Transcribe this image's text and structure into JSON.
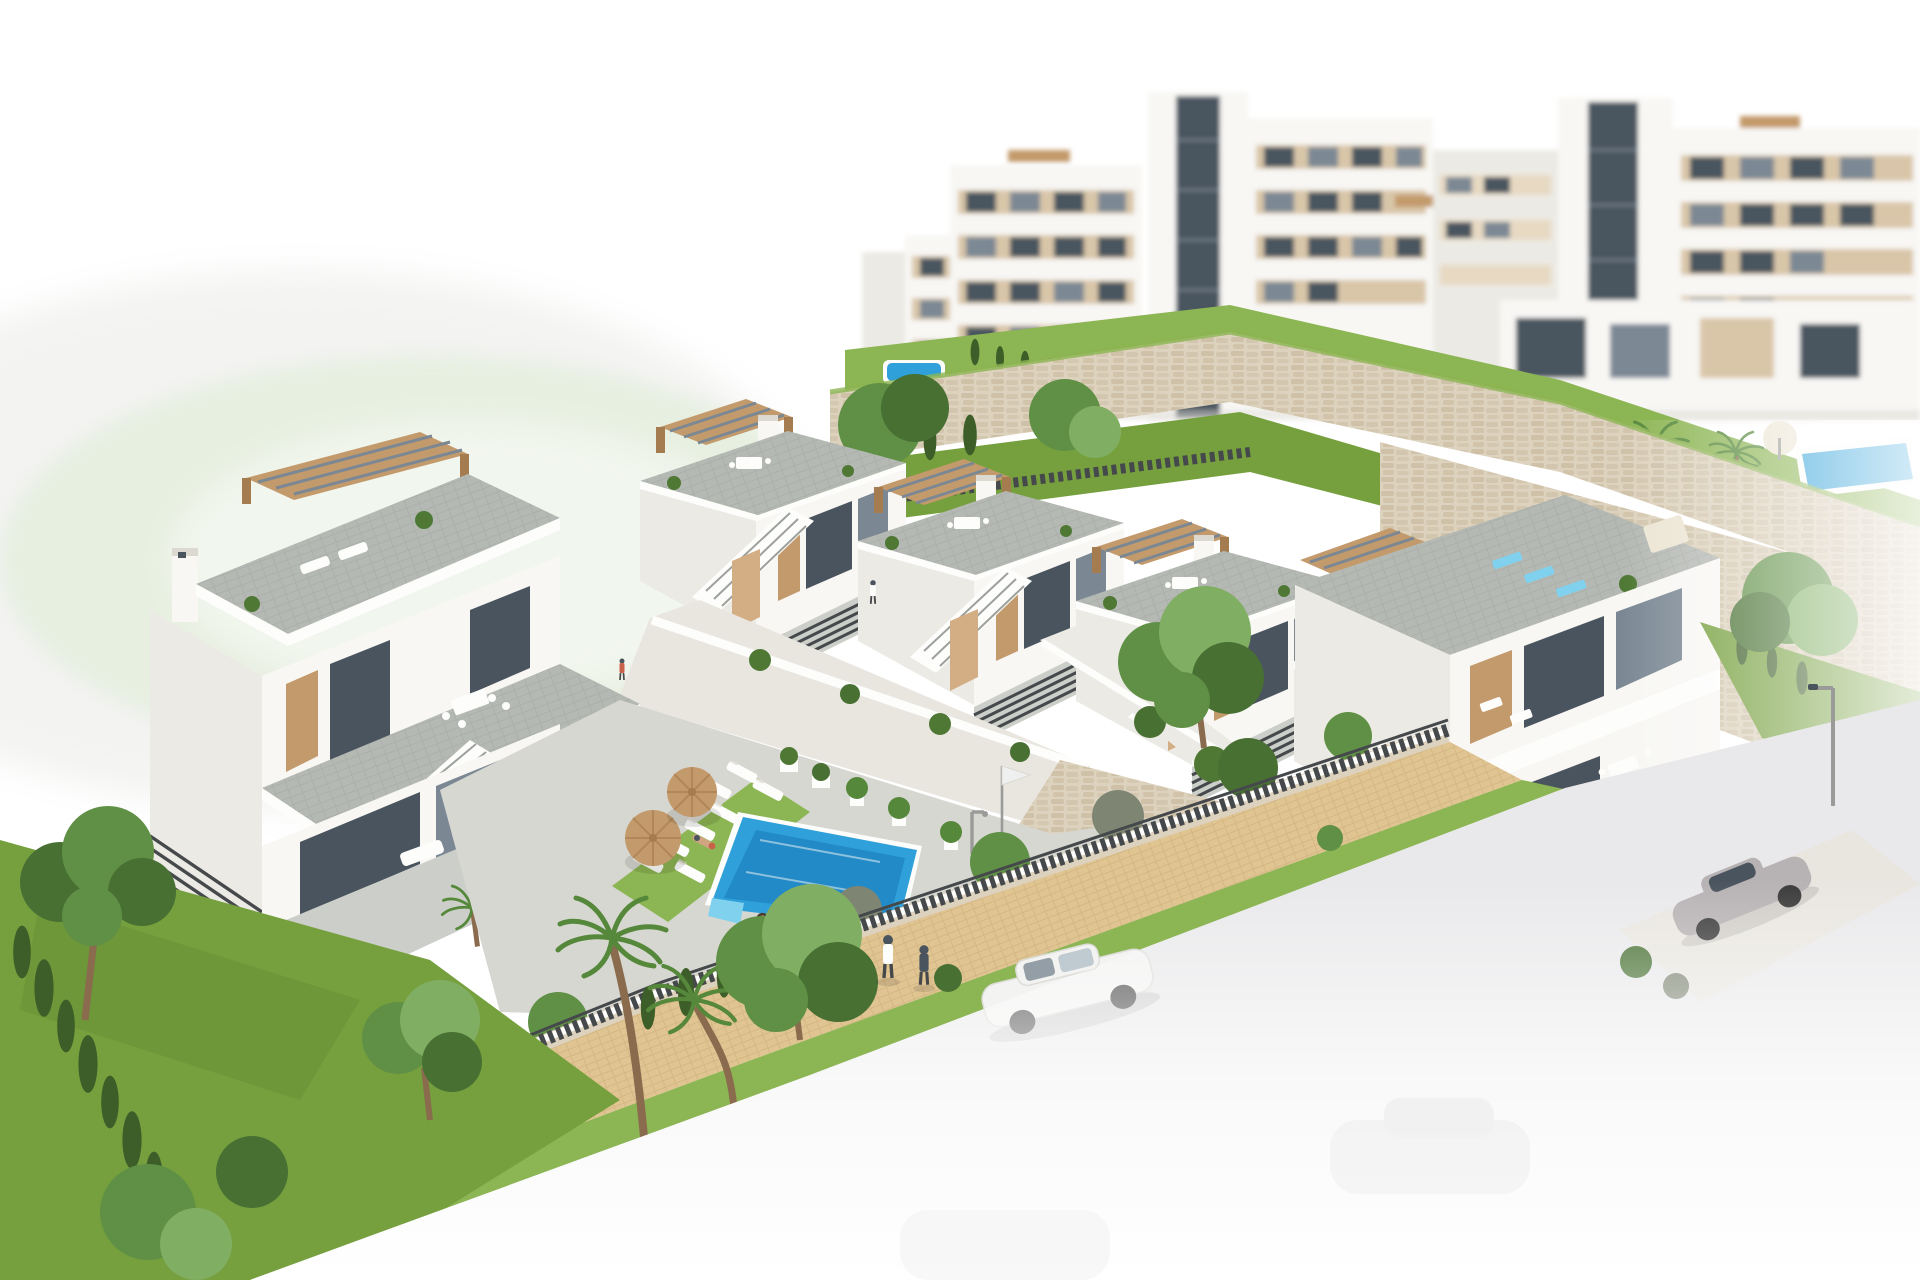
{
  "image": {
    "title": "Aerial 3D architectural render of a new-build hillside residential development",
    "type": "architectural-visualization",
    "view": "aerial three-quarter view, background and foreground faded to white",
    "description": "White modern townhouses with tan wood pergolas and external staircases step down a hillside with stone retaining walls. Behind them stand taller white apartment blocks with beige panels and glass balconies. In front is a communal pool area with a blue swimming pool, white sun loungers, two straw parasols and planters. A sandy paved path with hedges, trees, palms and a dark slat fence runs along the bottom, beside a road with a white car, a silver sports car by a garage driveway, and two pedestrians walking.",
    "objects": [
      "apartment-blocks",
      "stone-retaining-walls",
      "townhouse-row",
      "end-townhouse",
      "left-villa",
      "swimming-pool",
      "sun-loungers",
      "straw-umbrellas",
      "pool-deck",
      "planters",
      "pool-shower",
      "flag-pole",
      "lawns",
      "pine-tree",
      "palm-trees",
      "cypress-hedges",
      "shrubs",
      "boundary-wall",
      "slat-fence",
      "sand-path",
      "road",
      "white-car",
      "silver-sports-car",
      "garage",
      "driveway",
      "street-lamp",
      "pedestrians",
      "swimmer",
      "sunbather",
      "communal-upper-pool"
    ],
    "counts": {
      "townhouse_units_middle_row": 4,
      "straw_umbrellas": 2,
      "poolside_sun_loungers": 8,
      "pedestrians": 2,
      "cars_visible": 2,
      "pools": 3
    }
  },
  "palette": {
    "page_bg": "#ffffff",
    "haze_green": "#e3eedb",
    "haze_grey": "#ececea",
    "bldg_white": "#f8f7f4",
    "bldg_shade": "#eceae4",
    "bldg_dark": "#dcd9d1",
    "parapet": "#fdfdfc",
    "beige": "#d9c6a9",
    "beige_soft": "#e7d9c2",
    "glass_dark": "#4a545e",
    "glass_mid": "#7b8894",
    "glass_light": "#b3bfc8",
    "wood": "#c39a6b",
    "wood_dark": "#a57c4f",
    "wood_light": "#d3ae84",
    "slat": "#46494b",
    "tile": "#b5b9b4",
    "tile_dark": "#9da19c",
    "tile_light": "#cccfc9",
    "stone": "#ddd2bd",
    "stone_dark": "#c7b89d",
    "concrete": "#e9e6e0",
    "deck": "#d7d7d1",
    "lawn": "#76a03e",
    "lawn_light": "#8cb553",
    "lawn_dark": "#5e8630",
    "hedge": "#4e7833",
    "cypress": "#3d5e28",
    "tree": "#5f9045",
    "tree_light": "#80af63",
    "tree_dark": "#477032",
    "bush_grey": "#7e8573",
    "palm": "#55883a",
    "trunk": "#8a6b4e",
    "sand": "#e0c593",
    "sand_line": "#c9ab78",
    "pool": "#2fa0d9",
    "pool_deep": "#1879b8",
    "pool_light": "#80d1ee",
    "road": "#e9e9eb",
    "car_white": "#f3f3f2",
    "car_silver": "#b7b2b4",
    "metal": "#9a9a98",
    "skin": "#cfa582",
    "red": "#c9604a",
    "cream": "#ece5d4"
  }
}
